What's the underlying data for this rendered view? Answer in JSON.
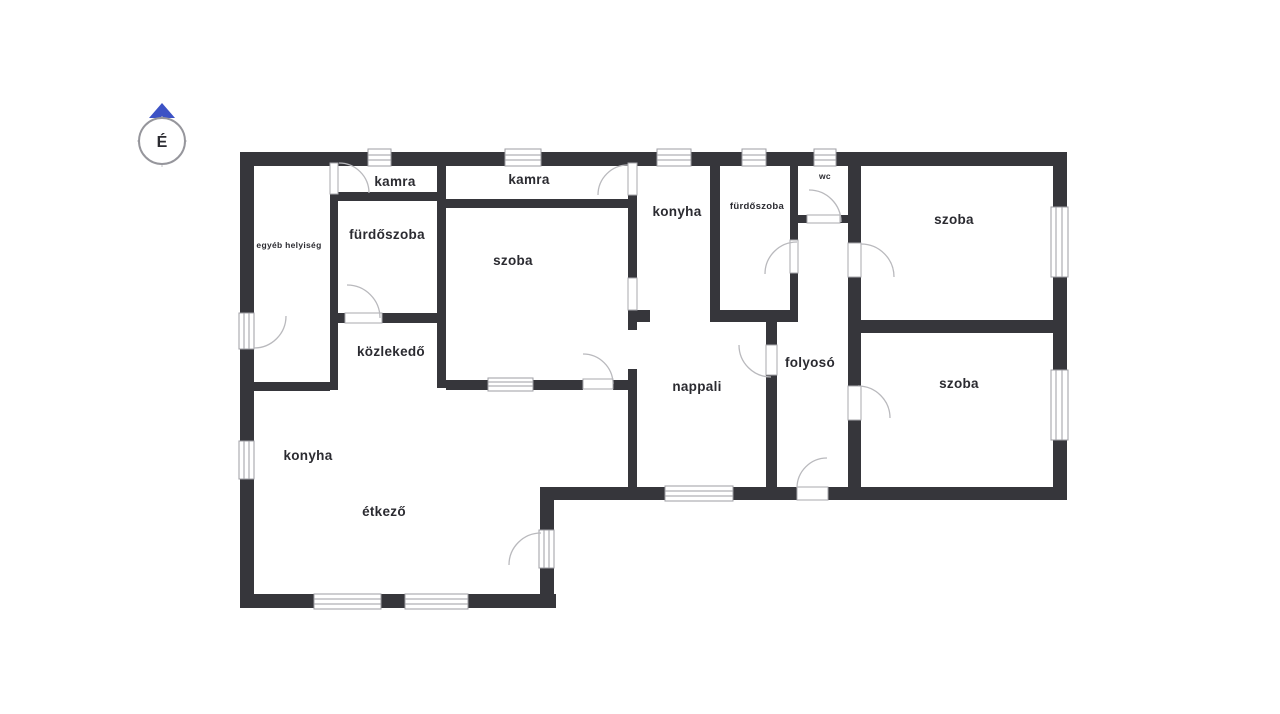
{
  "plan": {
    "type": "floor-plan",
    "language": "hu"
  },
  "compass": {
    "letter": "É",
    "arrow_color": "#3c52c5"
  },
  "colors": {
    "wall": "#36363b",
    "label_text": "#2b2b31",
    "door_arc": "#b9b9bd",
    "window_frame": "#9d9da3",
    "background": "#ffffff"
  },
  "rooms": [
    {
      "id": "egyeb-helyiseg",
      "label": "egyéb helyiség"
    },
    {
      "id": "kamra-1",
      "label": "kamra"
    },
    {
      "id": "kamra-2",
      "label": "kamra"
    },
    {
      "id": "furdoszoba-1",
      "label": "fürdőszoba"
    },
    {
      "id": "szoba-kozepso",
      "label": "szoba"
    },
    {
      "id": "konyha-felso",
      "label": "konyha"
    },
    {
      "id": "furdoszoba-2",
      "label": "fürdőszoba"
    },
    {
      "id": "wc",
      "label": "wc"
    },
    {
      "id": "szoba-jobb-felso",
      "label": "szoba"
    },
    {
      "id": "kozlekedo",
      "label": "közlekedő"
    },
    {
      "id": "nappali",
      "label": "nappali"
    },
    {
      "id": "folyoso",
      "label": "folyosó"
    },
    {
      "id": "szoba-jobb-also",
      "label": "szoba"
    },
    {
      "id": "konyha-also",
      "label": "konyha"
    },
    {
      "id": "etkezo",
      "label": "étkező"
    }
  ]
}
